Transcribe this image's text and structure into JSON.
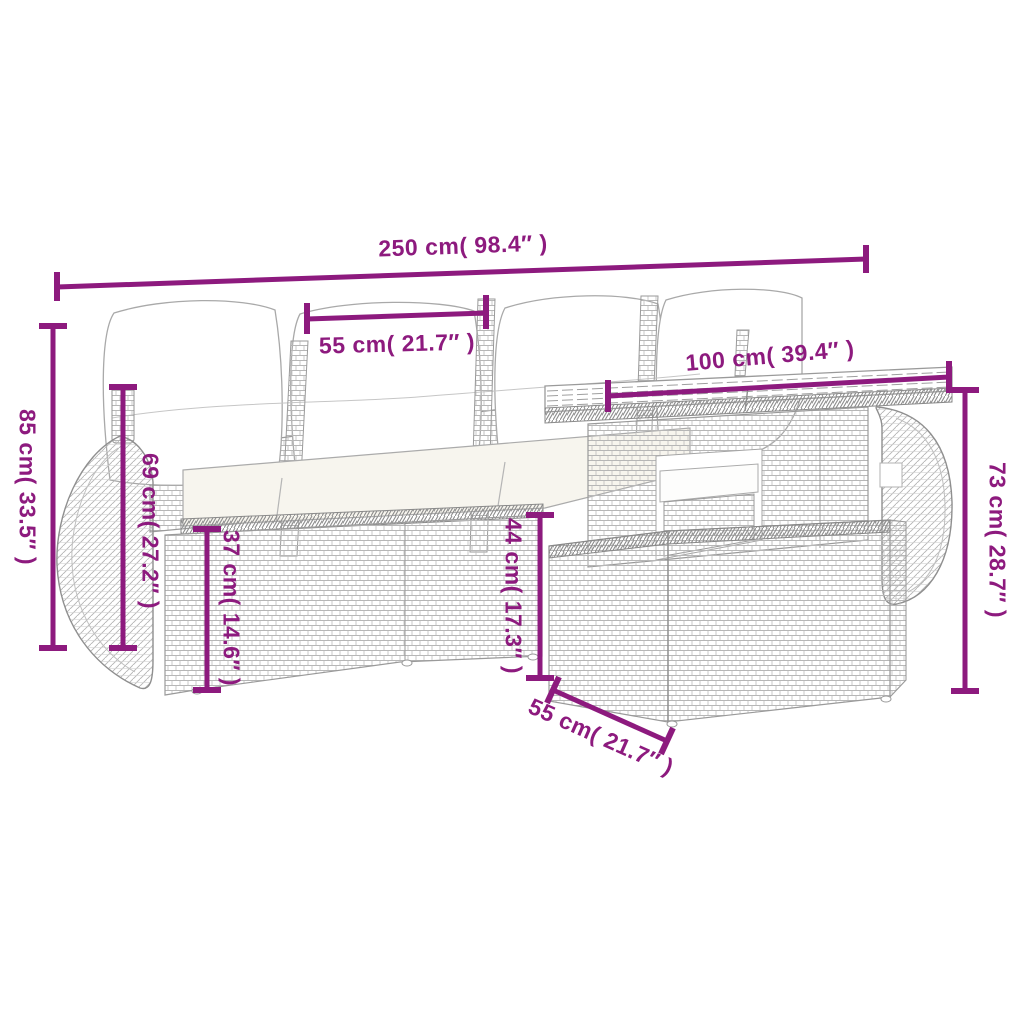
{
  "title": "Rattan garden lounge set with table - dimension diagram",
  "colors": {
    "accent": "#8d1a7e",
    "line_art": "#9a9a9a",
    "background": "#ffffff",
    "cushion": "#ffffff"
  },
  "dimensions": [
    {
      "id": "overall-width",
      "cm": "250",
      "inches": "98.4",
      "label": "250 cm( 98.4″ )"
    },
    {
      "id": "seat-width",
      "cm": "55",
      "inches": "21.7",
      "label": "55 cm( 21.7″ )"
    },
    {
      "id": "table-length",
      "cm": "100",
      "inches": "39.4",
      "label": "100 cm( 39.4″ )"
    },
    {
      "id": "back-height",
      "cm": "85",
      "inches": "33.5",
      "label": "85 cm( 33.5″ )"
    },
    {
      "id": "arm-height",
      "cm": "69",
      "inches": "27.2",
      "label": "69 cm( 27.2″ )"
    },
    {
      "id": "base-height",
      "cm": "37",
      "inches": "14.6",
      "label": "37 cm( 14.6″ )"
    },
    {
      "id": "seat-height",
      "cm": "44",
      "inches": "17.3",
      "label": "44 cm( 17.3″ )"
    },
    {
      "id": "table-height",
      "cm": "73",
      "inches": "28.7",
      "label": "73 cm( 28.7″ )"
    },
    {
      "id": "ottoman-depth",
      "cm": "55",
      "inches": "21.7",
      "label": "55 cm( 21.7″ )"
    }
  ]
}
